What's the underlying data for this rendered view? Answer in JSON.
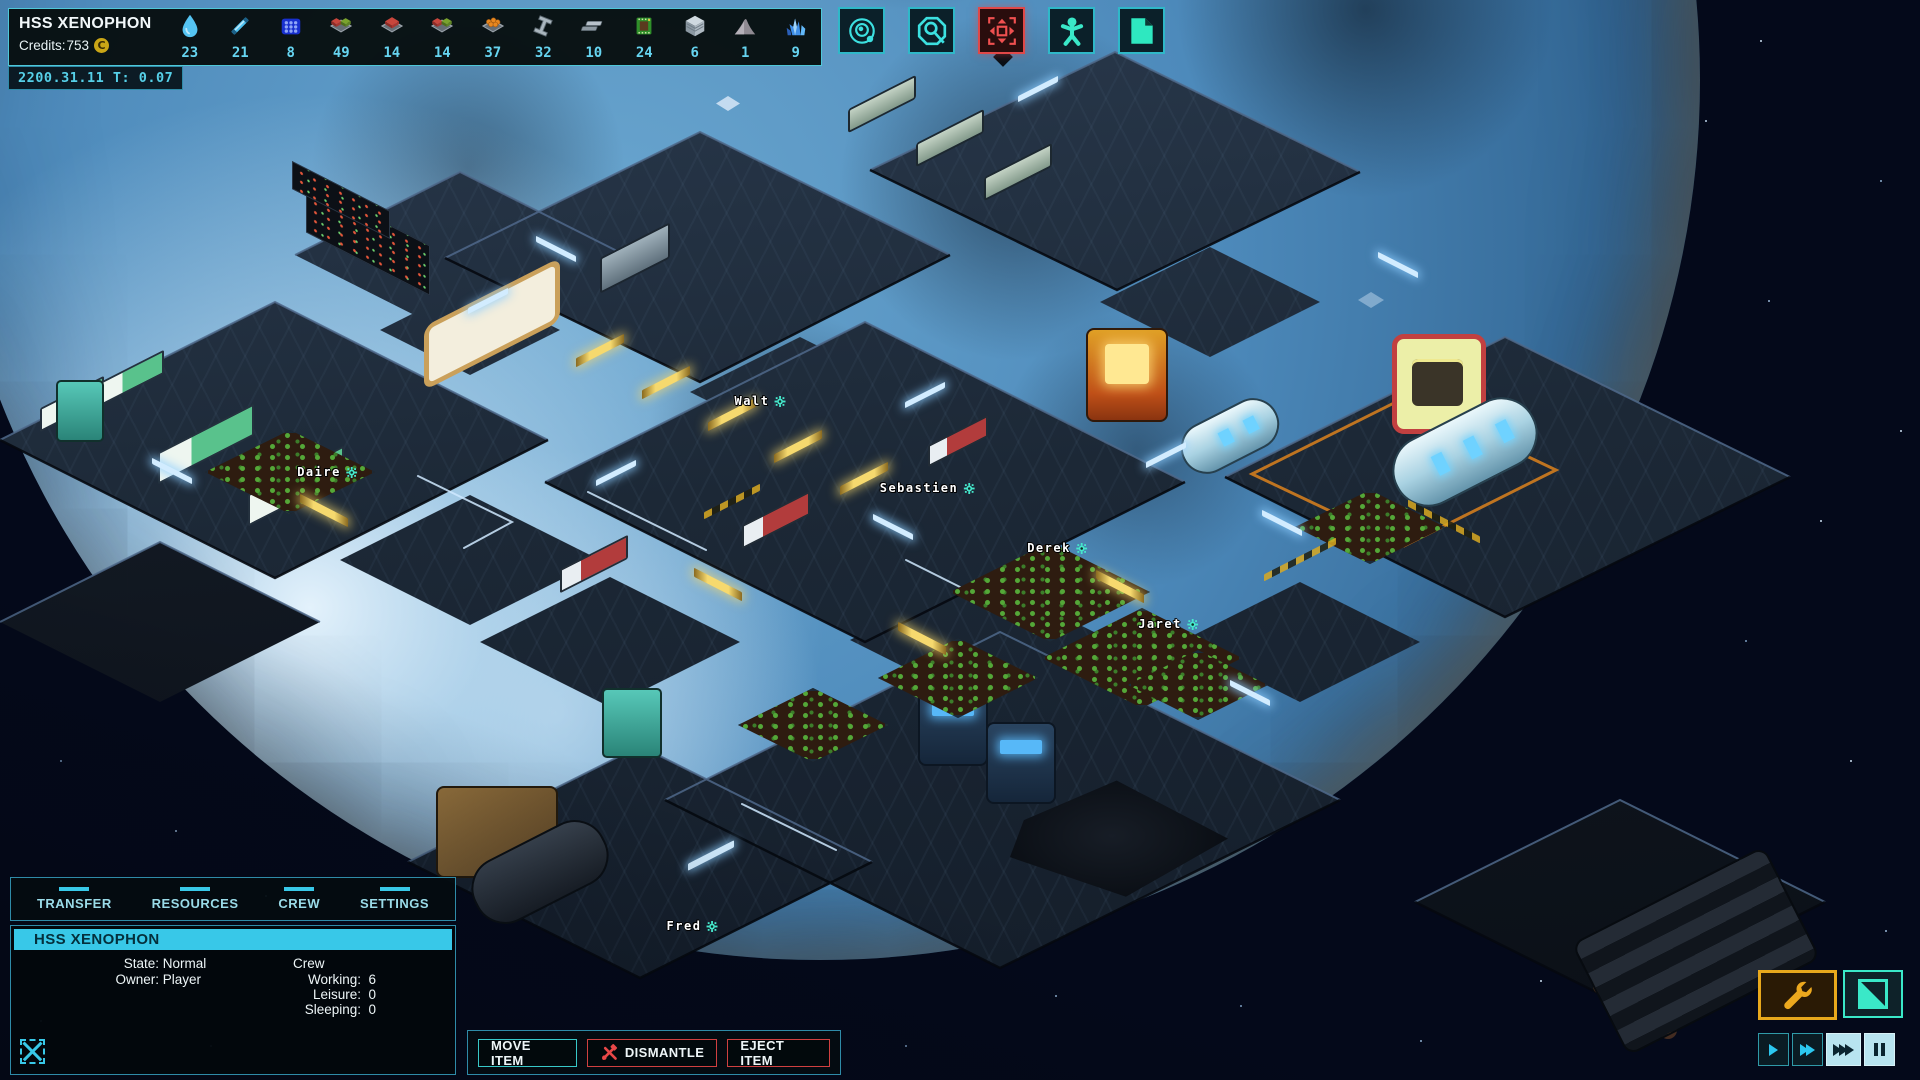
{
  "header": {
    "ship_name": "HSS XENOPHON",
    "credits_label": "Credits:",
    "credits_value": "753",
    "credits_symbol": "C",
    "datetime": "2200.31.11 T: 0.07",
    "resources": [
      {
        "name": "water",
        "count": "23"
      },
      {
        "name": "energy-rod",
        "count": "21"
      },
      {
        "name": "ice-block",
        "count": "8"
      },
      {
        "name": "ration-mixed",
        "count": "49"
      },
      {
        "name": "ration-red",
        "count": "14"
      },
      {
        "name": "ration-mixed-2",
        "count": "14"
      },
      {
        "name": "fruit",
        "count": "37"
      },
      {
        "name": "steel-beam",
        "count": "32"
      },
      {
        "name": "metal-plate",
        "count": "10"
      },
      {
        "name": "circuit-chip",
        "count": "24"
      },
      {
        "name": "alloy-block",
        "count": "6"
      },
      {
        "name": "sand",
        "count": "1"
      },
      {
        "name": "crystal",
        "count": "9"
      }
    ]
  },
  "toolbar": {
    "buttons": [
      {
        "icon": "orbit"
      },
      {
        "icon": "research-scan"
      },
      {
        "icon": "build-move"
      },
      {
        "icon": "crew"
      },
      {
        "icon": "ship-blueprint"
      }
    ]
  },
  "world": {
    "crew": [
      {
        "name": "Walt"
      },
      {
        "name": "Daire"
      },
      {
        "name": "Sebastien"
      },
      {
        "name": "Derek"
      },
      {
        "name": "Jaret"
      },
      {
        "name": "Fred"
      }
    ]
  },
  "ship_panel": {
    "tabs": [
      {
        "label": "TRANSFER"
      },
      {
        "label": "RESOURCES"
      },
      {
        "label": "CREW"
      },
      {
        "label": "SETTINGS"
      }
    ],
    "title": "HSS XENOPHON",
    "state_label": "State:",
    "state_value": "Normal",
    "owner_label": "Owner:",
    "owner_value": "Player",
    "crew_header": "Crew",
    "crew_rows": [
      {
        "label": "Working:",
        "value": "6"
      },
      {
        "label": "Leisure:",
        "value": "0"
      },
      {
        "label": "Sleeping:",
        "value": "0"
      }
    ]
  },
  "action_bar": {
    "move_item": "MOVE ITEM",
    "dismantle": "DISMANTLE",
    "eject_item": "EJECT ITEM"
  },
  "colors": {
    "accent": "#38c8e8",
    "alert": "#e04848",
    "warning": "#e8a81c",
    "panel_border": "#2f8ba8",
    "count_text": "#66d4f0",
    "selected_bg": "#b8e4f0"
  }
}
